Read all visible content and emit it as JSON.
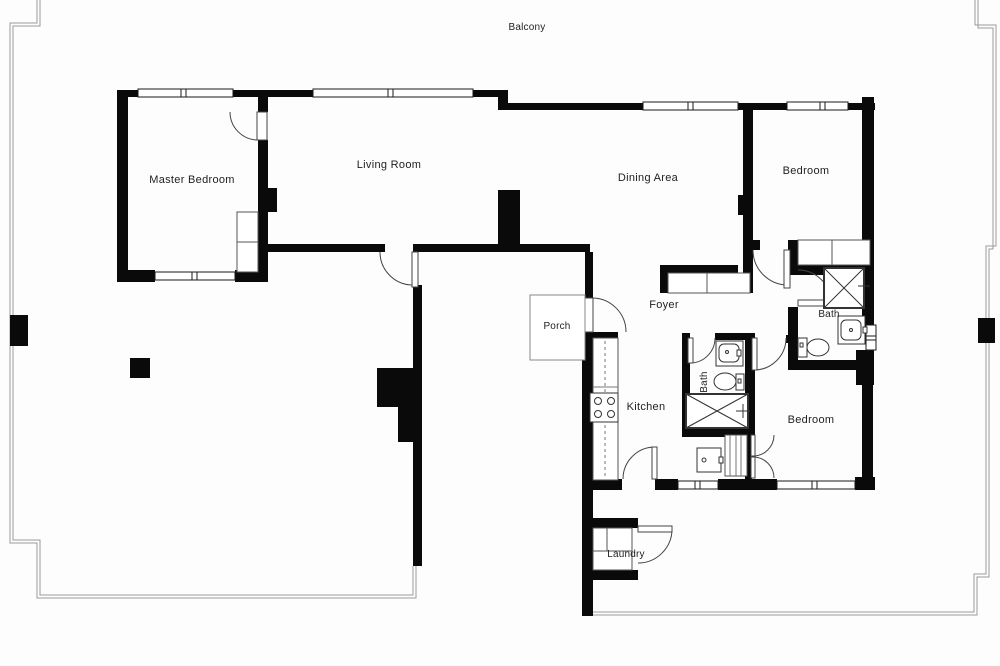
{
  "figure": "apartment-floor-plan",
  "colors": {
    "wall": "#0a0a0a",
    "balcony_line": "#9a9a9a",
    "fixture_line": "#333333",
    "text": "#1f1f1f",
    "background": "#fdfdfd"
  },
  "rooms": {
    "balcony": {
      "label": "Balcony"
    },
    "master_bedroom": {
      "label": "Master Bedroom"
    },
    "living_room": {
      "label": "Living Room"
    },
    "dining_area": {
      "label": "Dining Area"
    },
    "bedroom_top": {
      "label": "Bedroom"
    },
    "foyer": {
      "label": "Foyer"
    },
    "porch": {
      "label": "Porch"
    },
    "bath_right": {
      "label": "Bath"
    },
    "bath_mid": {
      "label": "Bath"
    },
    "kitchen": {
      "label": "Kitchen"
    },
    "bedroom_bottom": {
      "label": "Bedroom"
    },
    "laundry": {
      "label": "Laundry"
    }
  },
  "icons": [
    "stove-icon",
    "shower-icon",
    "toilet-icon",
    "sink-icon",
    "washer-dryer-icon",
    "closet-icon",
    "door-arc-icon",
    "window-icon",
    "column-icon"
  ]
}
